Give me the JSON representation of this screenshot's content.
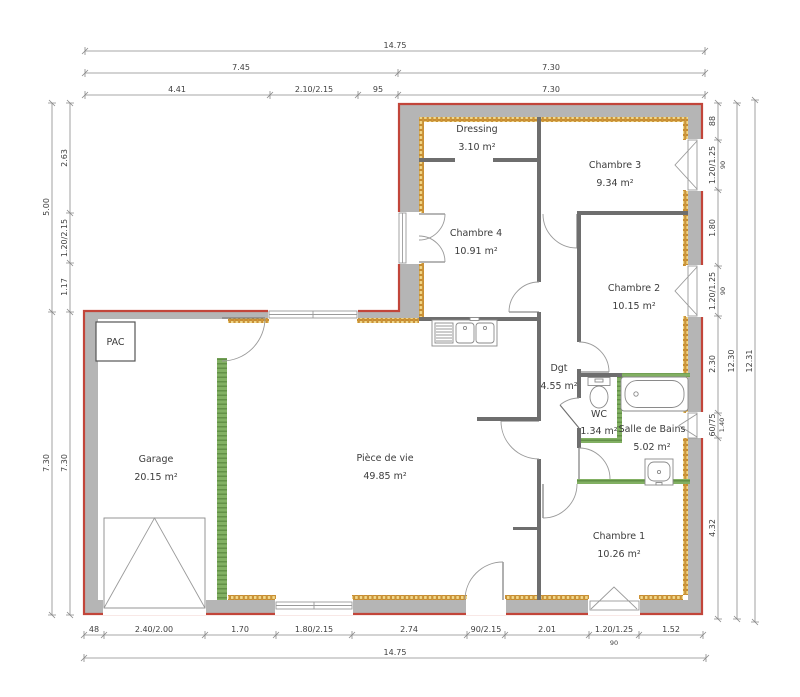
{
  "plan": {
    "rooms": [
      {
        "name": "Dressing",
        "area": "3.10 m²"
      },
      {
        "name": "Chambre 3",
        "area": "9.34 m²"
      },
      {
        "name": "Chambre 4",
        "area": "10.91 m²"
      },
      {
        "name": "Chambre 2",
        "area": "10.15 m²"
      },
      {
        "name": "Garage",
        "area": "20.15 m²"
      },
      {
        "name": "Pièce de vie",
        "area": "49.85 m²"
      },
      {
        "name": "Dgt",
        "area": "4.55 m²"
      },
      {
        "name": "WC",
        "area": "1.34 m²"
      },
      {
        "name": "Salle de Bains",
        "area": "5.02 m²"
      },
      {
        "name": "Chambre 1",
        "area": "10.26 m²"
      }
    ],
    "labels": {
      "pac": "PAC"
    },
    "dimensions": {
      "top": [
        "14.75",
        "7.45",
        "7.30",
        "4.41",
        "2.10/2.15",
        "95",
        "7.30"
      ],
      "left": [
        "5.00",
        "7.30",
        "2.63",
        "1.20/2.15",
        "1.17",
        "7.30"
      ],
      "right": [
        "88",
        "1.20/1.25",
        "90",
        "1.80",
        "1.20/1.25",
        "90",
        "2.30",
        "60/75",
        "1.40",
        "4.32",
        "12.30",
        "12.31"
      ],
      "bottom": [
        "48",
        "2.40/2.00",
        "1.70",
        "1.80/2.15",
        "2.74",
        "90/2.15",
        "2.01",
        "1.20/1.25",
        "90",
        "1.52",
        "14.75"
      ]
    },
    "colors": {
      "exterior_outline": "#c2453a",
      "exterior_wall": "#b5b5b5",
      "insulation_fill": "#f3d98b",
      "insulation_border": "#b27a20",
      "partition_green": "#82b063",
      "interior_wall": "#6e6e6e"
    }
  }
}
